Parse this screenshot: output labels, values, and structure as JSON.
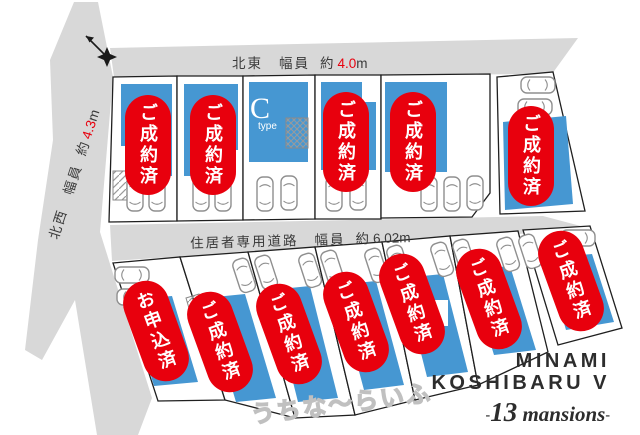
{
  "plan": {
    "compass_icon": "north-compass",
    "roads": {
      "top": {
        "direction": "北東",
        "label": "幅員",
        "approx": "約",
        "value": "4.0",
        "unit": "m"
      },
      "left": {
        "direction": "北西",
        "label": "幅員",
        "approx": "約",
        "value": "4.3",
        "unit": "m"
      },
      "middle": {
        "name": "住居者専用道路",
        "label": "幅員",
        "approx": "約",
        "value": "6.02",
        "unit": "m"
      }
    },
    "lots": [
      {
        "no": 1,
        "row": "top",
        "status": "ご成約済"
      },
      {
        "no": 2,
        "row": "top",
        "status": "ご成約済"
      },
      {
        "no": 3,
        "row": "top",
        "status": "",
        "c_label": "C",
        "c_sub": "type"
      },
      {
        "no": 4,
        "row": "top",
        "status": "ご成約済"
      },
      {
        "no": 5,
        "row": "top",
        "status": "ご成約済"
      },
      {
        "no": 6,
        "row": "top",
        "status": "ご成約済"
      },
      {
        "no": 7,
        "row": "bottom",
        "status": "お申込済"
      },
      {
        "no": 8,
        "row": "bottom",
        "status": "ご成約済"
      },
      {
        "no": 9,
        "row": "bottom",
        "status": "ご成約済"
      },
      {
        "no": 10,
        "row": "bottom",
        "status": "ご成約済"
      },
      {
        "no": 11,
        "row": "bottom",
        "status": "ご成約済"
      },
      {
        "no": 12,
        "row": "bottom",
        "status": "ご成約済"
      },
      {
        "no": 13,
        "row": "bottom",
        "status": "ご成約済"
      }
    ],
    "watermark": "うちな〜らいふ",
    "brand": {
      "line1": "MINAMI",
      "line2": "KOSHIBARU V",
      "dash": "-",
      "number": "13",
      "word": "mansions"
    },
    "colors": {
      "badge_red": "#e8000d",
      "building_blue": "#4697d2",
      "road_gray": "#d8d8d8"
    }
  }
}
